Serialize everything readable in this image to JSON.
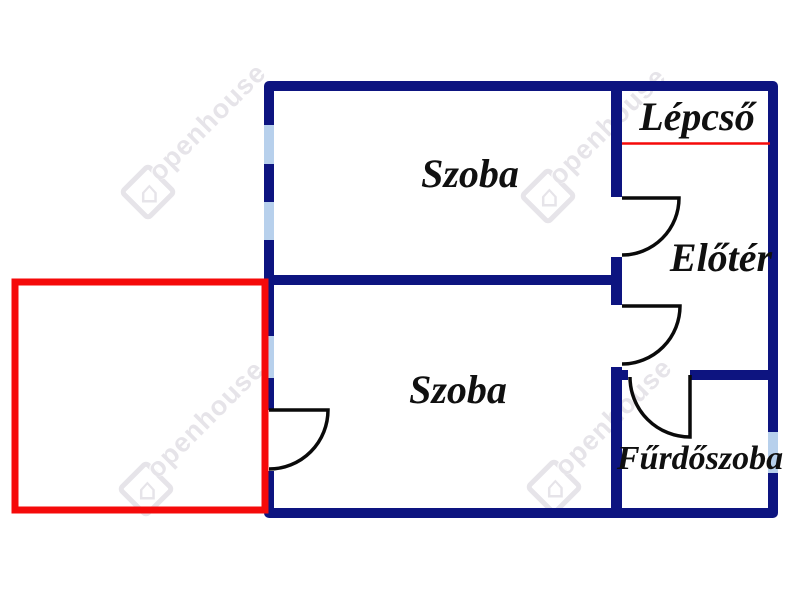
{
  "page": {
    "background": "#ffffff"
  },
  "colors": {
    "background": "#ffffff",
    "wall": "#0d1480",
    "window": "#b7d0ec",
    "terrace": "#f50a0a",
    "stair_line": "#f50a0a",
    "door": "#0a0a0a",
    "label": "#101010",
    "watermark": "#e6e4e9"
  },
  "rooms": {
    "szoba_top": {
      "label": "Szoba"
    },
    "szoba_bottom": {
      "label": "Szoba"
    },
    "lepcso": {
      "label": "Lépcső"
    },
    "eloter": {
      "label": "Előtér"
    },
    "furdoszoba": {
      "label": "Fűrdőszoba"
    }
  },
  "watermark": {
    "text": "openhouse",
    "logo_icon": "house-in-diamond",
    "house_glyph": "⌂"
  }
}
